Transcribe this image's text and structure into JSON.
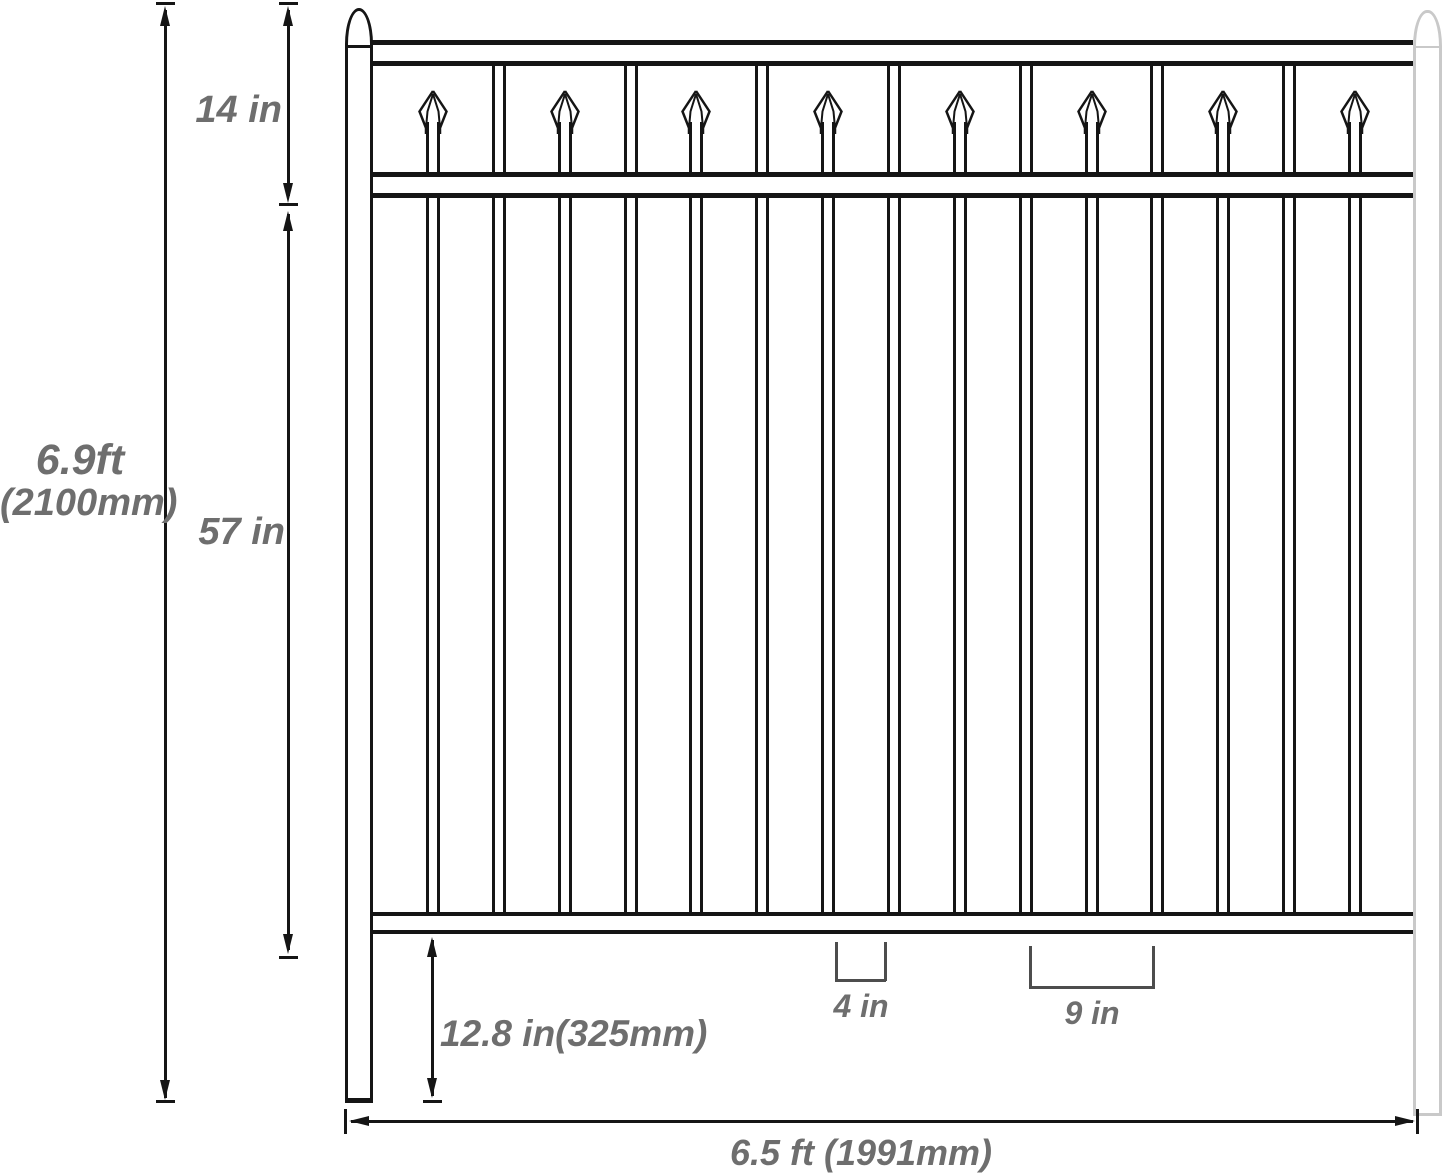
{
  "labels": {
    "total_height_ft": "6.9ft",
    "total_height_mm": "(2100mm)",
    "top_section_height": "14 in",
    "picket_section_height": "57 in",
    "ground_clearance": "12.8 in(325mm)",
    "picket_gap": "4 in",
    "picket_spacing": "9 in",
    "total_width": "6.5 ft (1991mm)"
  },
  "fence": {
    "pickets_total": 15,
    "spear_pickets": 8,
    "flat_pickets": 7,
    "rails": 3,
    "posts": 2
  },
  "colors": {
    "line": "#151515",
    "right_post_line": "#c9c9c9",
    "label_text": "#6e6e6e",
    "bracket_line": "#4d4d4d",
    "background": "#ffffff"
  }
}
